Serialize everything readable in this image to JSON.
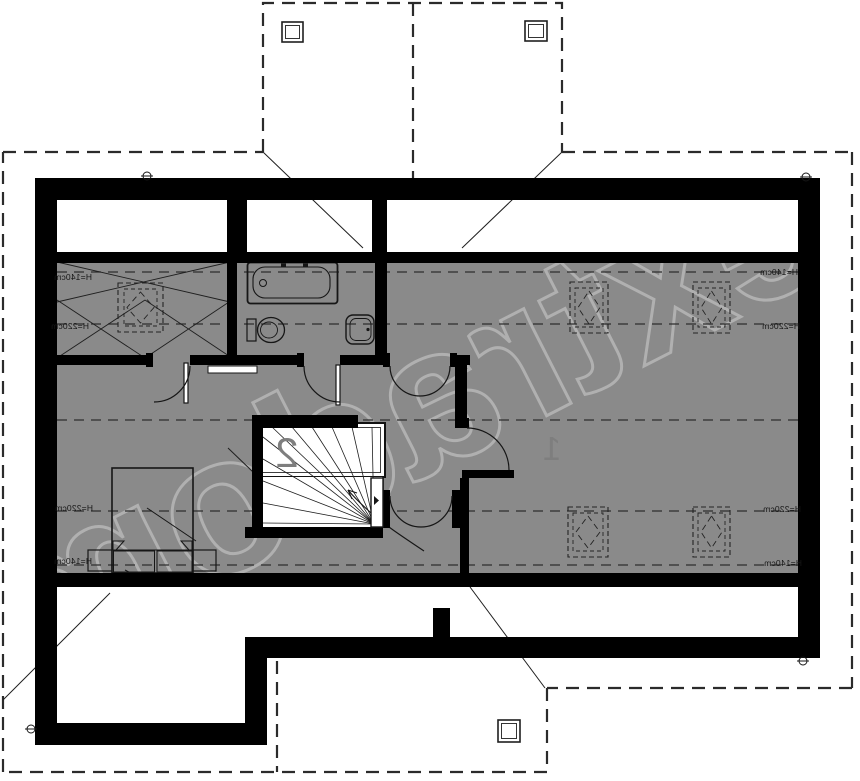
{
  "colors": {
    "background": "#ffffff",
    "floor": "#8a8a8a",
    "wall": "#000000",
    "line": "#1f1f1f",
    "room_number": "#7e7e7e",
    "watermark": "#ffffff"
  },
  "watermark": {
    "text": "extradom"
  },
  "height_labels": {
    "h140": "H=140cm",
    "h220": "H=220cm"
  },
  "room_numbers": {
    "staircase": "2",
    "main_room": "1"
  }
}
